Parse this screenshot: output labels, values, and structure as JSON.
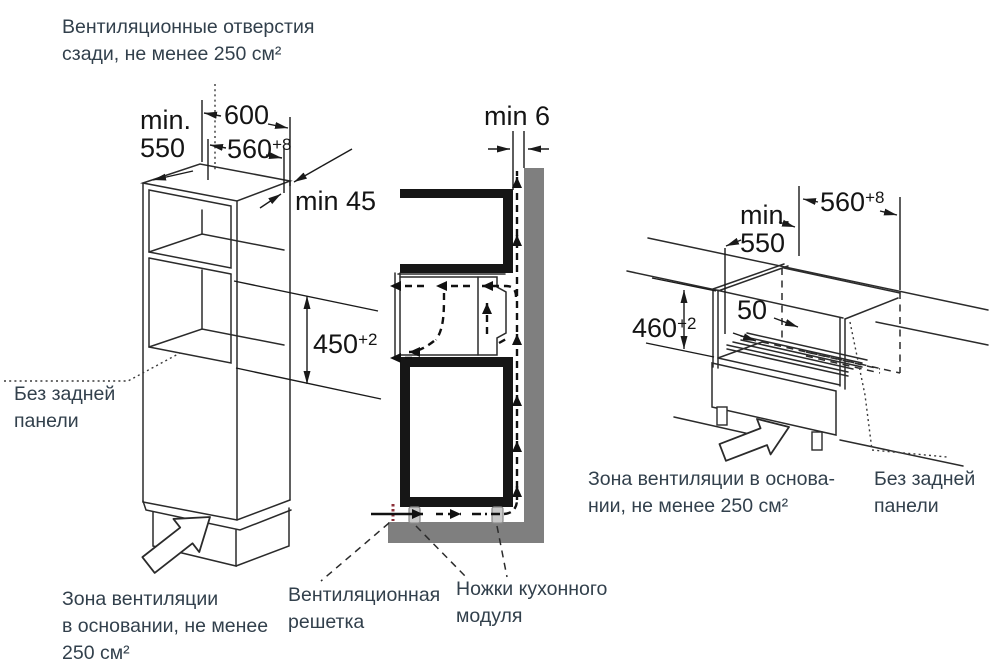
{
  "notes": {
    "vent_rear": "Вентиляционные отверстия\nсзади, не менее 250 см²",
    "no_back_left": "Без задней\nпанели",
    "base_vent_left": "Зона вентиляции\nв основании, не менее\n250 см²",
    "grille": "Вентиляционная\nрешетка",
    "module_feet": "Ножки кухонного\nмодуля",
    "base_vent_right": "Зона вентиляции в основа-\nнии, не менее 250 см²",
    "no_back_right": "Без задней\nпанели"
  },
  "left_view": {
    "min_label": "min.\n550",
    "d600": "600",
    "d560": {
      "value": "560",
      "tol": "+8"
    },
    "min45": "min 45",
    "d450": {
      "value": "450",
      "tol": "+2"
    }
  },
  "section_view": {
    "min6": "min 6"
  },
  "right_view": {
    "min_label": "min.\n550",
    "d560": {
      "value": "560",
      "tol": "+8"
    },
    "d460": {
      "value": "460",
      "tol": "+2"
    },
    "d50": "50"
  },
  "colors": {
    "label_text": "#32404c",
    "dim_text": "#141414",
    "line": "#2b2b2b",
    "wall_gray": "#7f7f7f",
    "leg_gray": "#c9c9c9",
    "grille_red": "#8d3039",
    "background": "#ffffff"
  }
}
